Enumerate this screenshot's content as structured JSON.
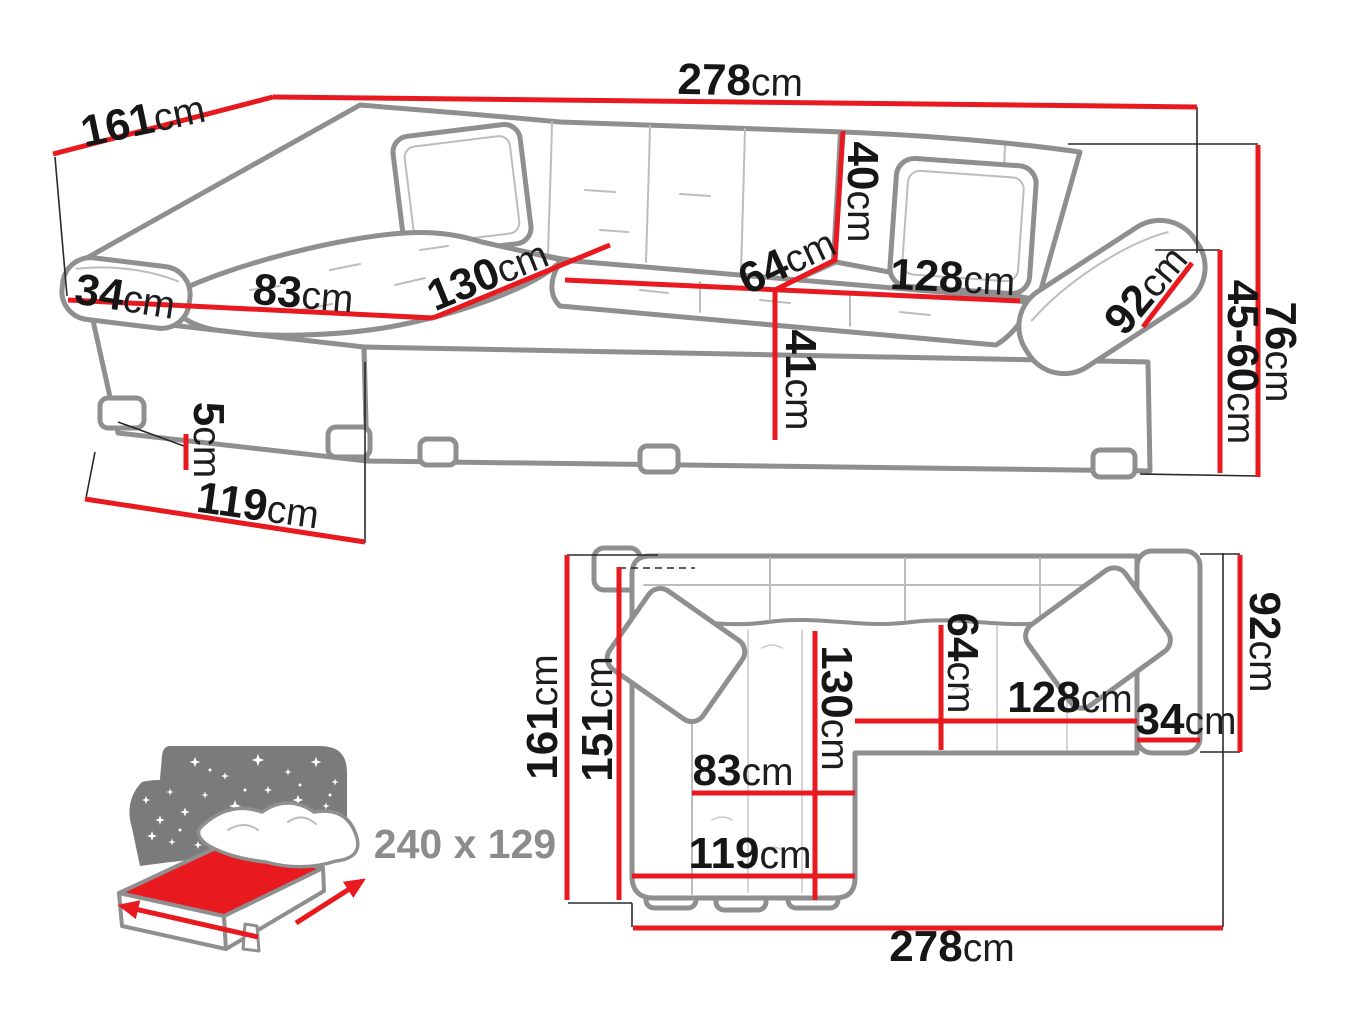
{
  "meta": {
    "background": "#ffffff",
    "dimension_line_color": "#e8191f",
    "outline_color": "#8f8f8f",
    "label_color": "#161616",
    "badge_color": "#8c8c8c"
  },
  "perspective": {
    "total_width": {
      "value": "278",
      "unit": "cm"
    },
    "total_depth": {
      "value": "161",
      "unit": "cm"
    },
    "left_arm_width": {
      "value": "34",
      "unit": "cm"
    },
    "chaise_cushion_width": {
      "value": "83",
      "unit": "cm"
    },
    "chaise_length": {
      "value": "130",
      "unit": "cm"
    },
    "seat_depth": {
      "value": "64",
      "unit": "cm"
    },
    "backrest_height": {
      "value": "40",
      "unit": "cm"
    },
    "seat_width": {
      "value": "128",
      "unit": "cm"
    },
    "right_arm_length": {
      "value": "92",
      "unit": "cm"
    },
    "seat_height": {
      "value": "41",
      "unit": "cm"
    },
    "leg_height": {
      "value": "5",
      "unit": "cm"
    },
    "chaise_front_width": {
      "value": "119",
      "unit": "cm"
    },
    "armrest_height_range": {
      "value": "45-60",
      "unit": "cm"
    },
    "total_height": {
      "value": "76",
      "unit": "cm"
    }
  },
  "plan": {
    "total_depth": {
      "value": "161",
      "unit": "cm"
    },
    "inner_depth": {
      "value": "151",
      "unit": "cm"
    },
    "chaise_length": {
      "value": "130",
      "unit": "cm"
    },
    "seat_depth": {
      "value": "64",
      "unit": "cm"
    },
    "seat_width": {
      "value": "128",
      "unit": "cm"
    },
    "right_arm_width": {
      "value": "34",
      "unit": "cm"
    },
    "right_arm_depth": {
      "value": "92",
      "unit": "cm"
    },
    "chaise_cushion_width": {
      "value": "83",
      "unit": "cm"
    },
    "chaise_front_width": {
      "value": "119",
      "unit": "cm"
    },
    "total_width": {
      "value": "278",
      "unit": "cm"
    }
  },
  "sleeping": {
    "dimensions_label": "240 x 129"
  }
}
